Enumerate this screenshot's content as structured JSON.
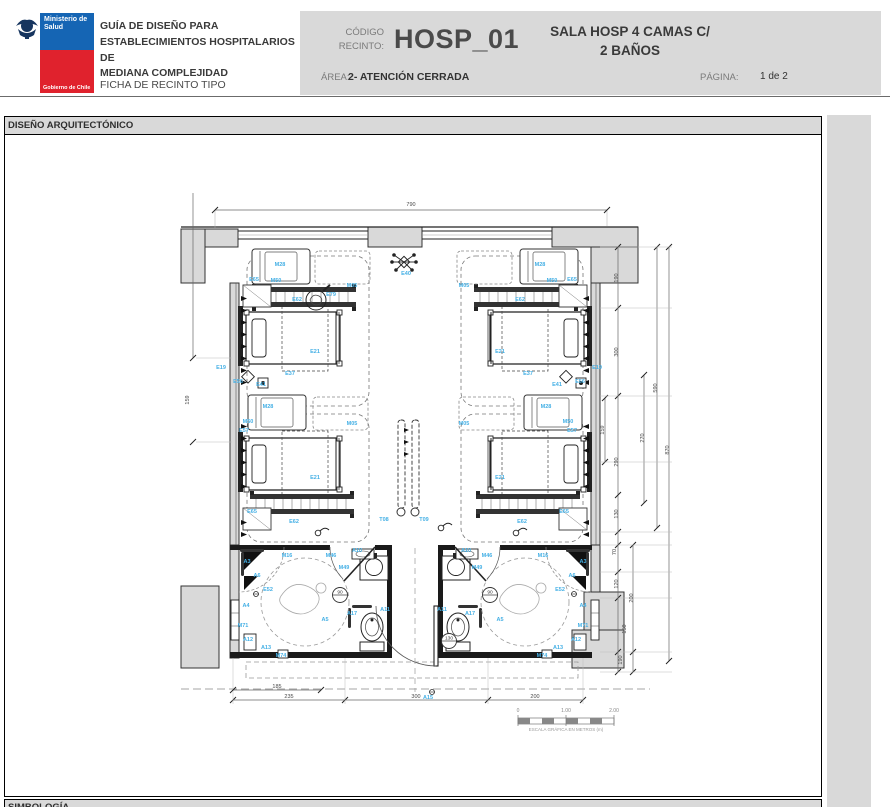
{
  "header": {
    "logo": {
      "ministry_line1": "Ministerio de",
      "ministry_line2": "Salud",
      "government": "Gobierno de Chile"
    },
    "title_lines": [
      "GUÍA DE DISEÑO PARA",
      "ESTABLECIMIENTOS HOSPITALARIOS DE",
      "MEDIANA COMPLEJIDAD"
    ],
    "subtitle": "FICHA DE RECINTO TIPO",
    "code_label_line1": "CÓDIGO",
    "code_label_line2": "RECINTO:",
    "code_value": "HOSP_01",
    "room_name_line1": "SALA HOSP 4 CAMAS C/",
    "room_name_line2": "2 BAÑOS",
    "area_label": "ÁREA:",
    "area_value": "2- ATENCIÓN CERRADA",
    "page_label": "PÁGINA:",
    "page_value": "1 de 2"
  },
  "sections": {
    "design": "DISEÑO ARQUITECTÓNICO",
    "symbology": "SIMBOLOGÍA"
  },
  "plan": {
    "colors": {
      "label": "#45b0e5",
      "wall_fill": "#d9d9d9",
      "line": "#1a1a1a",
      "dim": "#4a4a4a"
    },
    "equipment_labels": [
      {
        "t": "M28",
        "x": 280,
        "y": 266
      },
      {
        "t": "M50",
        "x": 276,
        "y": 282
      },
      {
        "t": "E65",
        "x": 254,
        "y": 281
      },
      {
        "t": "E62",
        "x": 297,
        "y": 301
      },
      {
        "t": "E79",
        "x": 331,
        "y": 296
      },
      {
        "t": "M05",
        "x": 352,
        "y": 287
      },
      {
        "t": "E21",
        "x": 315,
        "y": 353
      },
      {
        "t": "E37",
        "x": 290,
        "y": 375
      },
      {
        "t": "E19",
        "x": 221,
        "y": 369
      },
      {
        "t": "E56",
        "x": 238,
        "y": 383
      },
      {
        "t": "E41",
        "x": 261,
        "y": 386
      },
      {
        "t": "M28",
        "x": 268,
        "y": 408
      },
      {
        "t": "M50",
        "x": 248,
        "y": 423
      },
      {
        "t": "M05",
        "x": 352,
        "y": 425
      },
      {
        "t": "E57",
        "x": 244,
        "y": 432
      },
      {
        "t": "E21",
        "x": 315,
        "y": 479
      },
      {
        "t": "E65",
        "x": 252,
        "y": 513
      },
      {
        "t": "E62",
        "x": 294,
        "y": 523
      },
      {
        "t": "M28",
        "x": 540,
        "y": 266
      },
      {
        "t": "M50",
        "x": 552,
        "y": 282
      },
      {
        "t": "E65",
        "x": 572,
        "y": 281
      },
      {
        "t": "E62",
        "x": 520,
        "y": 301
      },
      {
        "t": "M05",
        "x": 464,
        "y": 287
      },
      {
        "t": "E21",
        "x": 500,
        "y": 353
      },
      {
        "t": "E37",
        "x": 528,
        "y": 375
      },
      {
        "t": "E19",
        "x": 597,
        "y": 369
      },
      {
        "t": "E56",
        "x": 580,
        "y": 383
      },
      {
        "t": "E41",
        "x": 557,
        "y": 386
      },
      {
        "t": "M28",
        "x": 546,
        "y": 408
      },
      {
        "t": "M50",
        "x": 568,
        "y": 423
      },
      {
        "t": "M05",
        "x": 464,
        "y": 425
      },
      {
        "t": "E57",
        "x": 572,
        "y": 432
      },
      {
        "t": "E21",
        "x": 500,
        "y": 479
      },
      {
        "t": "E65",
        "x": 564,
        "y": 513
      },
      {
        "t": "E62",
        "x": 522,
        "y": 523
      },
      {
        "t": "E40",
        "x": 406,
        "y": 275
      },
      {
        "t": "T08",
        "x": 384,
        "y": 521
      },
      {
        "t": "T09",
        "x": 424,
        "y": 521
      },
      {
        "t": "M16",
        "x": 287,
        "y": 557
      },
      {
        "t": "M46",
        "x": 331,
        "y": 557
      },
      {
        "t": "M49",
        "x": 344,
        "y": 569
      },
      {
        "t": "A10",
        "x": 357,
        "y": 552
      },
      {
        "t": "A3",
        "x": 247,
        "y": 563
      },
      {
        "t": "A6",
        "x": 257,
        "y": 577
      },
      {
        "t": "E52",
        "x": 268,
        "y": 591
      },
      {
        "t": "A4",
        "x": 246,
        "y": 607
      },
      {
        "t": "A5",
        "x": 325,
        "y": 621
      },
      {
        "t": "A17",
        "x": 352,
        "y": 615
      },
      {
        "t": "A11",
        "x": 385,
        "y": 611
      },
      {
        "t": "M71",
        "x": 243,
        "y": 627
      },
      {
        "t": "A12",
        "x": 248,
        "y": 641
      },
      {
        "t": "A13",
        "x": 266,
        "y": 649
      },
      {
        "t": "M74",
        "x": 281,
        "y": 657
      },
      {
        "t": "M16",
        "x": 543,
        "y": 557
      },
      {
        "t": "M46",
        "x": 487,
        "y": 557
      },
      {
        "t": "M49",
        "x": 477,
        "y": 569
      },
      {
        "t": "A10",
        "x": 466,
        "y": 552
      },
      {
        "t": "A3",
        "x": 583,
        "y": 563
      },
      {
        "t": "A6",
        "x": 572,
        "y": 577
      },
      {
        "t": "E52",
        "x": 560,
        "y": 591
      },
      {
        "t": "A4",
        "x": 583,
        "y": 607
      },
      {
        "t": "A5",
        "x": 500,
        "y": 621
      },
      {
        "t": "A17",
        "x": 470,
        "y": 615
      },
      {
        "t": "A11",
        "x": 442,
        "y": 611
      },
      {
        "t": "M71",
        "x": 583,
        "y": 627
      },
      {
        "t": "A12",
        "x": 576,
        "y": 641
      },
      {
        "t": "A13",
        "x": 558,
        "y": 649
      },
      {
        "t": "M74",
        "x": 542,
        "y": 657
      },
      {
        "t": "A15",
        "x": 428,
        "y": 699
      }
    ],
    "dimensions": [
      {
        "t": "790",
        "x": 411,
        "y": 206,
        "r": 0
      },
      {
        "t": "159",
        "x": 189,
        "y": 400,
        "r": -90
      },
      {
        "t": "190",
        "x": 618,
        "y": 278,
        "r": -90
      },
      {
        "t": "300",
        "x": 618,
        "y": 352,
        "r": -90
      },
      {
        "t": "159",
        "x": 604,
        "y": 430,
        "r": -90
      },
      {
        "t": "290",
        "x": 618,
        "y": 462,
        "r": -90
      },
      {
        "t": "130",
        "x": 618,
        "y": 514,
        "r": -90
      },
      {
        "t": "70",
        "x": 616,
        "y": 552,
        "r": -90
      },
      {
        "t": "120",
        "x": 618,
        "y": 584,
        "r": -90
      },
      {
        "t": "200",
        "x": 633,
        "y": 598,
        "r": -90
      },
      {
        "t": "150",
        "x": 626,
        "y": 629,
        "r": -90
      },
      {
        "t": "190",
        "x": 622,
        "y": 660,
        "r": -90
      },
      {
        "t": "270",
        "x": 644,
        "y": 438,
        "r": -90
      },
      {
        "t": "590",
        "x": 657,
        "y": 388,
        "r": -90
      },
      {
        "t": "870",
        "x": 669,
        "y": 450,
        "r": -90
      },
      {
        "t": "185",
        "x": 277,
        "y": 688,
        "r": 0
      },
      {
        "t": "235",
        "x": 289,
        "y": 698,
        "r": 0
      },
      {
        "t": "300",
        "x": 416,
        "y": 698,
        "r": 0
      },
      {
        "t": "200",
        "x": 535,
        "y": 698,
        "r": 0
      }
    ],
    "door_tags": [
      {
        "t": "90",
        "x": 340,
        "y": 595
      },
      {
        "t": "90",
        "x": 490,
        "y": 595
      },
      {
        "t": "130",
        "x": 449,
        "y": 641
      }
    ],
    "scale_bar": {
      "ticks": [
        "0",
        "1.00",
        "2.00"
      ],
      "caption": "ESCALA GRÁFICA EN METROS (m)"
    }
  }
}
